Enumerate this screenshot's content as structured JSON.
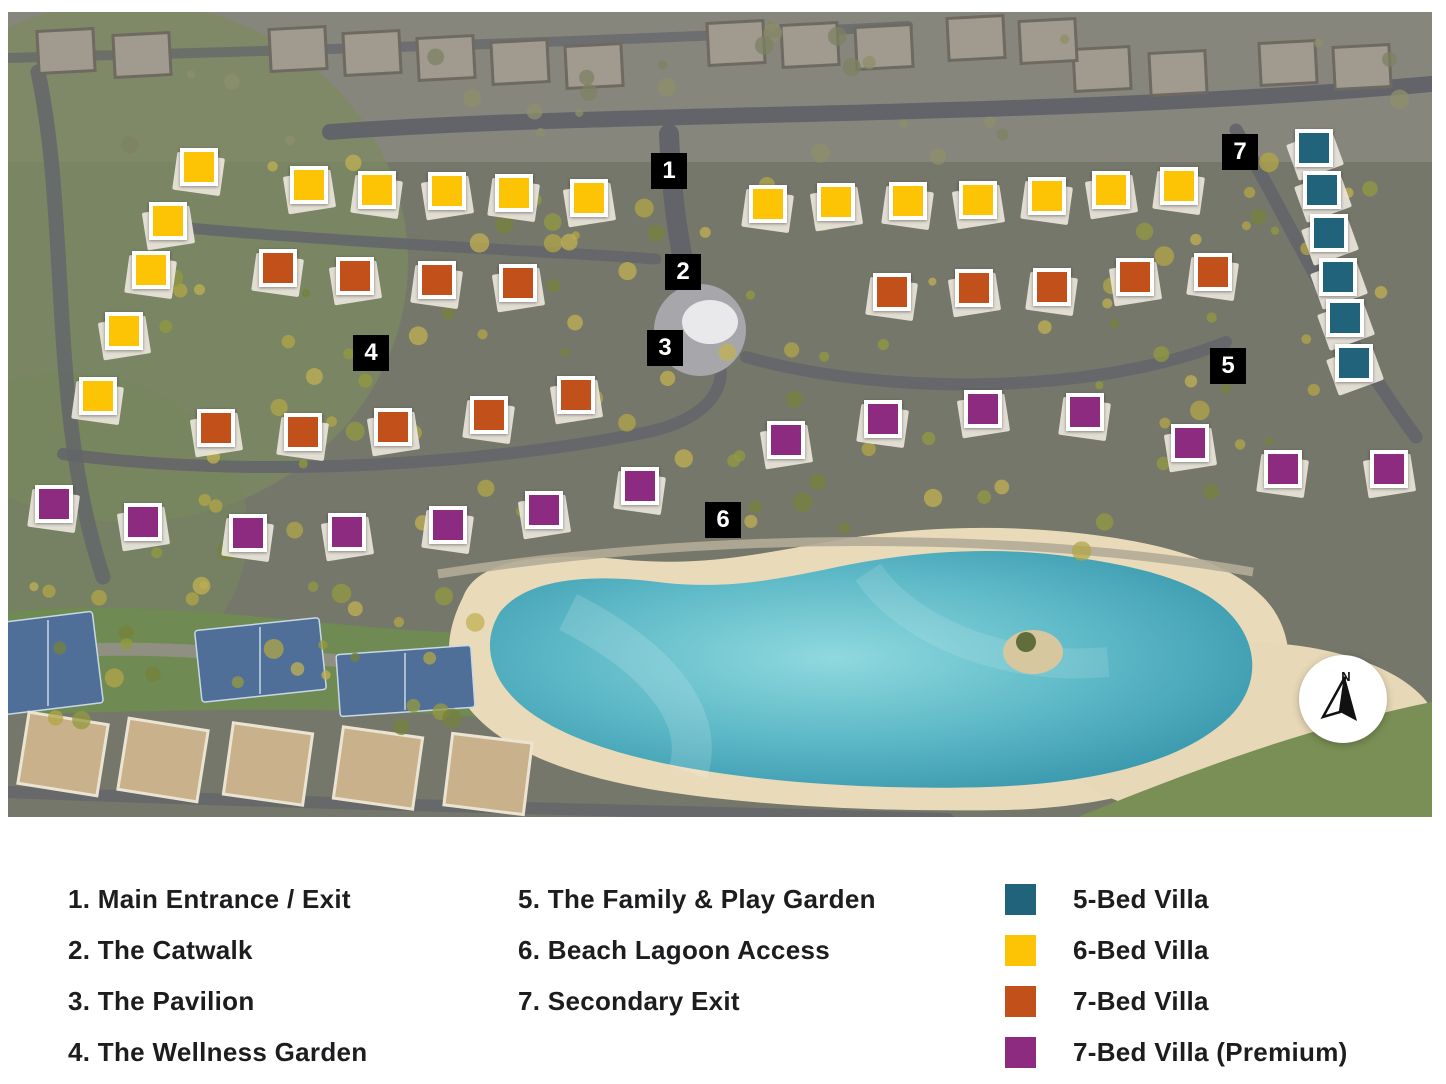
{
  "map": {
    "villa_types": [
      {
        "id": "5-bed",
        "label": "5-Bed Villa",
        "color": "#20637b",
        "positions": [
          [
            1314,
            148
          ],
          [
            1322,
            190
          ],
          [
            1329,
            233
          ],
          [
            1338,
            277
          ],
          [
            1345,
            318
          ],
          [
            1354,
            363
          ]
        ]
      },
      {
        "id": "6-bed",
        "label": "6-Bed Villa",
        "color": "#fcc405",
        "positions": [
          [
            199,
            167
          ],
          [
            168,
            221
          ],
          [
            151,
            270
          ],
          [
            124,
            331
          ],
          [
            98,
            396
          ],
          [
            309,
            185
          ],
          [
            377,
            190
          ],
          [
            447,
            191
          ],
          [
            514,
            193
          ],
          [
            589,
            198
          ],
          [
            768,
            204
          ],
          [
            836,
            202
          ],
          [
            908,
            201
          ],
          [
            978,
            200
          ],
          [
            1047,
            196
          ],
          [
            1111,
            190
          ],
          [
            1179,
            186
          ]
        ]
      },
      {
        "id": "7-bed",
        "label": "7-Bed Villa",
        "color": "#c1501a",
        "positions": [
          [
            278,
            268
          ],
          [
            355,
            276
          ],
          [
            437,
            280
          ],
          [
            518,
            283
          ],
          [
            892,
            292
          ],
          [
            974,
            288
          ],
          [
            1052,
            287
          ],
          [
            1135,
            277
          ],
          [
            1213,
            272
          ],
          [
            216,
            428
          ],
          [
            303,
            432
          ],
          [
            393,
            427
          ],
          [
            489,
            415
          ],
          [
            576,
            395
          ]
        ]
      },
      {
        "id": "7-bed-premium",
        "label": "7-Bed Villa (Premium)",
        "color": "#8c2b80",
        "positions": [
          [
            54,
            504
          ],
          [
            143,
            522
          ],
          [
            248,
            533
          ],
          [
            347,
            532
          ],
          [
            448,
            525
          ],
          [
            544,
            510
          ],
          [
            640,
            486
          ],
          [
            786,
            440
          ],
          [
            883,
            419
          ],
          [
            983,
            409
          ],
          [
            1085,
            412
          ],
          [
            1190,
            443
          ],
          [
            1283,
            469
          ],
          [
            1389,
            469
          ]
        ]
      }
    ],
    "poi_markers": [
      {
        "number": "1",
        "x": 669,
        "y": 171
      },
      {
        "number": "2",
        "x": 683,
        "y": 272
      },
      {
        "number": "3",
        "x": 665,
        "y": 348
      },
      {
        "number": "4",
        "x": 371,
        "y": 353
      },
      {
        "number": "5",
        "x": 1228,
        "y": 366
      },
      {
        "number": "6",
        "x": 723,
        "y": 520
      },
      {
        "number": "7",
        "x": 1240,
        "y": 152
      }
    ],
    "compass": {
      "label": "N"
    }
  },
  "legend": {
    "poi_items": [
      {
        "text": "1. Main Entrance / Exit"
      },
      {
        "text": "2. The Catwalk"
      },
      {
        "text": "3. The Pavilion"
      },
      {
        "text": "4. The Wellness Garden"
      },
      {
        "text": "5. The Family & Play Garden"
      },
      {
        "text": "6. Beach Lagoon Access"
      },
      {
        "text": "7. Secondary Exit"
      }
    ],
    "villa_items": [
      {
        "label": "5-Bed Villa",
        "color": "#20637b"
      },
      {
        "label": "6-Bed Villa",
        "color": "#fcc405"
      },
      {
        "label": "7-Bed Villa",
        "color": "#c1501a"
      },
      {
        "label": "7-Bed Villa (Premium)",
        "color": "#8c2b80"
      }
    ]
  }
}
